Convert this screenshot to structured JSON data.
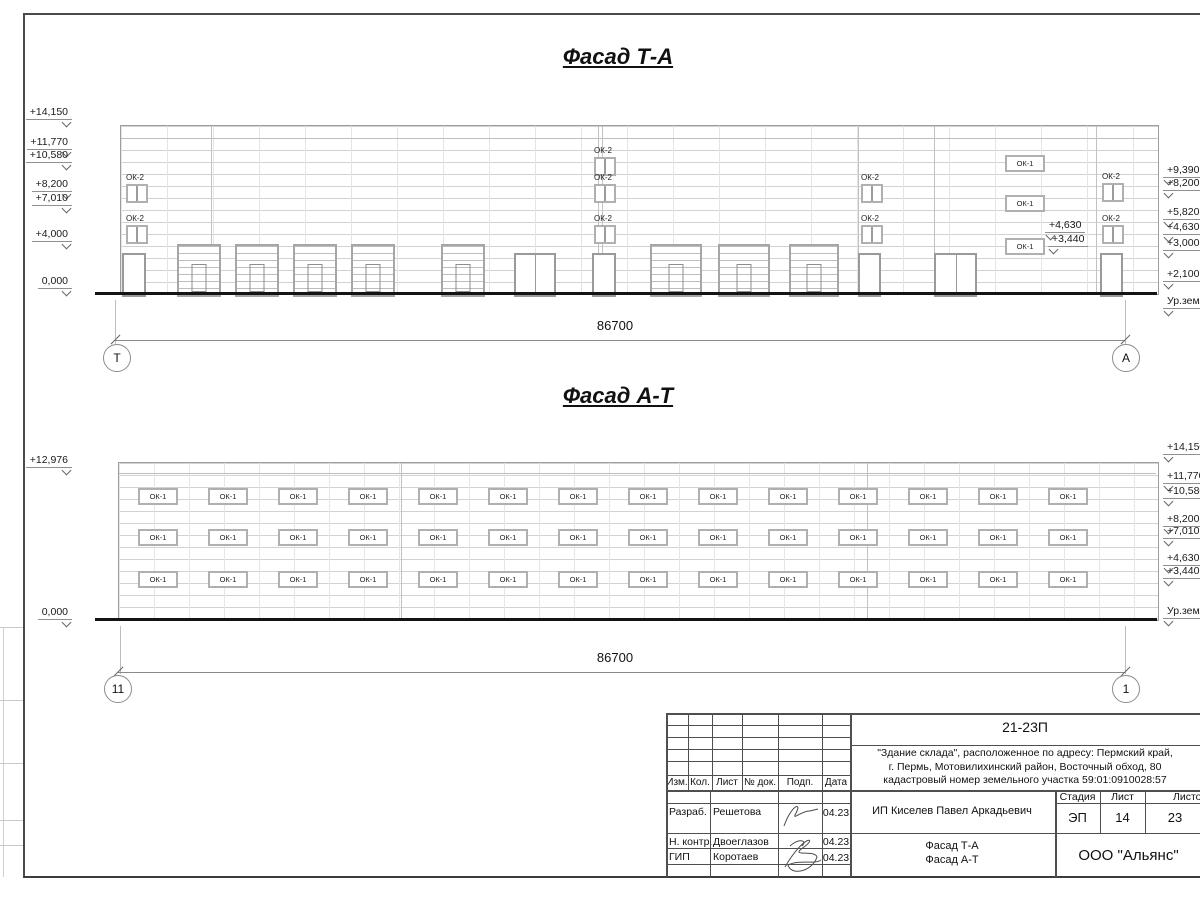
{
  "facade_top": {
    "title": "Фасад Т-А",
    "dimension": "86700",
    "axis_left": "Т",
    "axis_right": "А",
    "window_small_label": "ОК-2",
    "window_wide_label": "ОК-1",
    "marks_left": [
      "+14,150",
      "+11,770",
      "+10,580",
      "+8,200",
      "+7,010",
      "+4,000",
      "0,000"
    ],
    "marks_right": [
      "+9,390",
      "+8,200",
      "+5,820",
      "+4,630",
      "+3,000",
      "+2,100",
      "Ур.земли"
    ],
    "inner_marks": [
      "+4,630",
      "+3,440"
    ]
  },
  "facade_bottom": {
    "title": "Фасад А-Т",
    "dimension": "86700",
    "axis_left": "11",
    "axis_right": "1",
    "window_label": "ОК-1",
    "marks_left": [
      "+12,976",
      "0,000"
    ],
    "marks_right": [
      "+14,150",
      "+11,770",
      "+10,580",
      "+8,200",
      "+7,010",
      "+4,630",
      "+3,440",
      "Ур.земли"
    ]
  },
  "title_block": {
    "doc_number": "21-23П",
    "address_lines": [
      "\"Здание склада\", расположенное по адресу: Пермский край,",
      "г. Пермь, Мотовилихинский район, Восточный обход, 80",
      "кадастровый номер земельного участка 59:01:0910028:57"
    ],
    "header_cols": [
      "Изм.",
      "Кол.",
      "Лист",
      "№ док.",
      "Подп.",
      "Дата"
    ],
    "rows": [
      {
        "role": "Разраб.",
        "name": "Решетова",
        "date": "04.23"
      },
      {
        "role": "Н. контр.",
        "name": "Двоеглазов",
        "date": "04.23"
      },
      {
        "role": "ГИП",
        "name": "Коротаев",
        "date": "04.23"
      }
    ],
    "client": "ИП Киселев Павел Аркадьевич",
    "stage_label": "Стадия",
    "sheet_label": "Лист",
    "sheets_label": "Листов",
    "stage": "ЭП",
    "sheet_no": "14",
    "sheets_total": "23",
    "sheet_titles": [
      "Фасад Т-А",
      "Фасад А-Т"
    ],
    "company": "ООО \"Альянс\""
  }
}
